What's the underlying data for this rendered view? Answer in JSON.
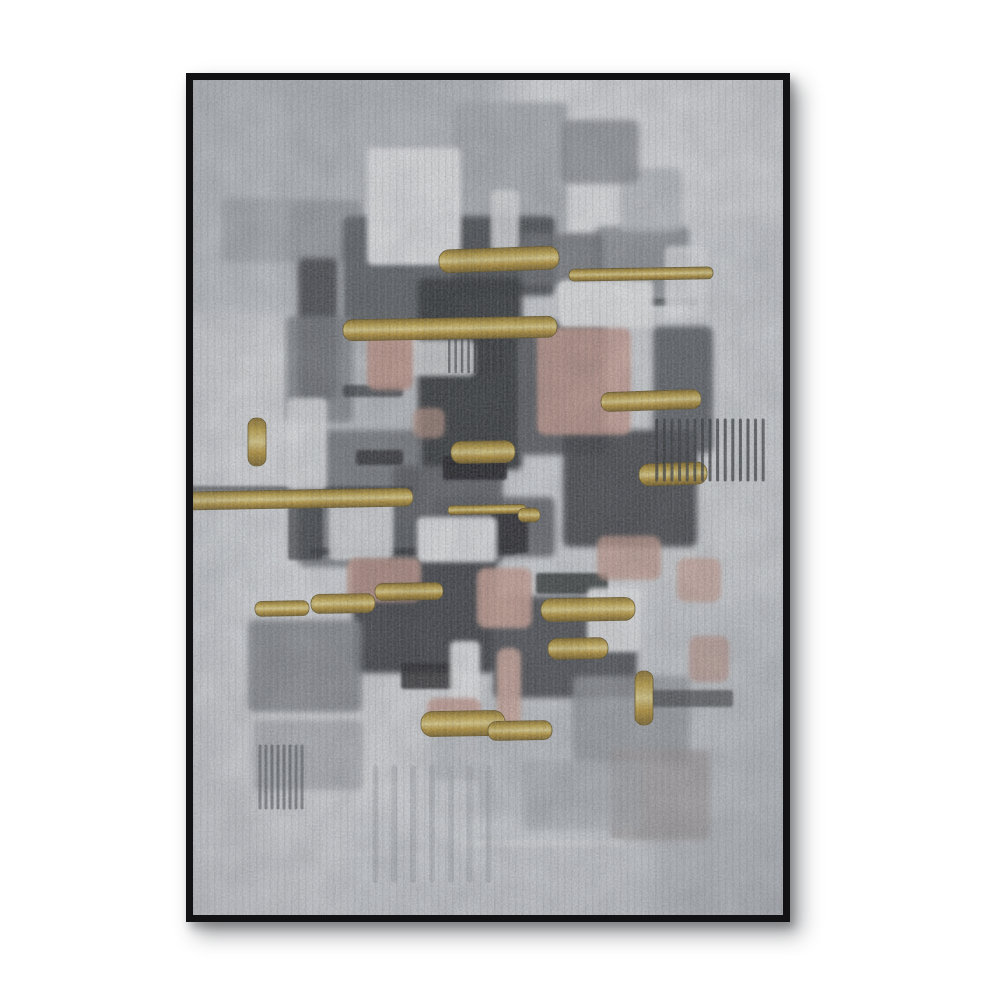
{
  "page": {
    "background": "#ffffff"
  },
  "frame": {
    "color": "#121214",
    "border_px": 7,
    "x": 186,
    "y": 73,
    "width": 604,
    "height": 849,
    "shadow_color": "rgba(40,42,48,0.45)"
  },
  "palette": {
    "canvas_base": "#d9dce0",
    "near_white": "#f2f3f5",
    "light_grey": "#c6cacf",
    "mid_grey": "#9aa0a5",
    "steel_grey": "#54585d",
    "charcoal": "#2f3236",
    "near_black": "#17191c",
    "pink": "#d3a395",
    "salmon": "#c9998b",
    "gold": "#c9a83f",
    "gold_light": "#efdd8d",
    "gold_dark": "#7b6220"
  },
  "painting": {
    "base": "#d9dce0",
    "viewbox": "0 0 590 835",
    "gold_gradient": [
      "#8a6d22",
      "#c9a83f",
      "#efdd8d",
      "#c29a33",
      "#7b6220"
    ],
    "washes": [
      [
        -25,
        -25,
        330,
        310,
        "#ced2d7",
        0.95
      ],
      [
        85,
        -15,
        215,
        265,
        "#bec3c8",
        0.75
      ],
      [
        325,
        -25,
        290,
        230,
        "#edeff1",
        1
      ],
      [
        420,
        140,
        185,
        390,
        "#dde0e3",
        0.9
      ],
      [
        -25,
        235,
        150,
        370,
        "#e6e8ea",
        0.9
      ],
      [
        -25,
        555,
        285,
        305,
        "#e2e4e7",
        0.95
      ],
      [
        235,
        625,
        380,
        235,
        "#c5c9ce",
        0.9
      ],
      [
        100,
        175,
        155,
        255,
        "#b7bcc1",
        0.6
      ],
      [
        455,
        530,
        160,
        215,
        "#ccd0d4",
        0.8
      ],
      [
        150,
        735,
        310,
        125,
        "#d8dbdf",
        0.9
      ],
      [
        -25,
        390,
        120,
        180,
        "#dfe2e5",
        0.8
      ]
    ],
    "blocks": [
      [
        95,
        120,
        74,
        62,
        "#9da1a6",
        0.9
      ],
      [
        260,
        22,
        114,
        132,
        "#b1b5ba",
        0.9
      ],
      [
        402,
        146,
        94,
        74,
        "#8e9297",
        0.9
      ],
      [
        150,
        136,
        114,
        120,
        "#5a5e63",
        0.95
      ],
      [
        260,
        136,
        102,
        80,
        "#45484d",
        0.95
      ],
      [
        225,
        198,
        104,
        192,
        "#2f3236",
        0.97
      ],
      [
        325,
        241,
        88,
        134,
        "#53575c",
        0.95
      ],
      [
        105,
        178,
        40,
        142,
        "#3c4044",
        0.9
      ],
      [
        370,
        350,
        134,
        117,
        "#3a3e43",
        0.92
      ],
      [
        460,
        246,
        60,
        127,
        "#4c5056",
        0.85
      ],
      [
        105,
        350,
        124,
        137,
        "#6e7277",
        0.85
      ],
      [
        160,
        476,
        144,
        117,
        "#33363b",
        0.93
      ],
      [
        300,
        516,
        144,
        102,
        "#3f434a",
        0.9
      ],
      [
        55,
        540,
        114,
        92,
        "#82868b",
        0.85
      ],
      [
        380,
        596,
        117,
        87,
        "#999da2",
        0.8
      ],
      [
        28,
        118,
        72,
        64,
        "#a9afb4",
        0.7
      ],
      [
        200,
        386,
        110,
        97,
        "#54585d",
        0.9
      ],
      [
        93,
        236,
        67,
        107,
        "#7c8085",
        0.8
      ],
      [
        427,
        88,
        62,
        64,
        "#c2c6ca",
        0.8
      ],
      [
        328,
        153,
        82,
        52,
        "#6a6e73",
        0.85
      ],
      [
        368,
        40,
        78,
        64,
        "#8b8f94",
        0.8
      ],
      [
        242,
        417,
        120,
        60,
        "#55595e",
        0.85
      ],
      [
        60,
        640,
        110,
        70,
        "#9ea2a7",
        0.6
      ],
      [
        417,
        670,
        100,
        90,
        "#a8a2a3",
        0.75
      ],
      [
        330,
        680,
        120,
        70,
        "#aeb2b7",
        0.6
      ]
    ],
    "accents": [
      [
        250,
        376,
        64,
        24,
        "#17191c",
        0.9
      ],
      [
        298,
        431,
        37,
        42,
        "#1b1e21",
        0.85
      ],
      [
        163,
        370,
        47,
        15,
        "#202327",
        0.8
      ],
      [
        228,
        116,
        32,
        28,
        "#212428",
        0.8
      ],
      [
        118,
        468,
        205,
        7,
        "#26292d",
        0.7
      ],
      [
        -5,
        406,
        225,
        6,
        "#2a2d31",
        0.6
      ],
      [
        443,
        610,
        97,
        17,
        "#3a3d41",
        0.7
      ],
      [
        208,
        583,
        62,
        26,
        "#202327",
        0.85
      ],
      [
        343,
        493,
        72,
        21,
        "#1d2023",
        0.8
      ],
      [
        150,
        305,
        60,
        12,
        "#26292d",
        0.7
      ],
      [
        385,
        218,
        120,
        8,
        "#2b2e32",
        0.65
      ],
      [
        95,
        425,
        35,
        55,
        "#2c2f33",
        0.7
      ]
    ],
    "whites": [
      [
        174,
        68,
        94,
        117,
        "#f2f3f5",
        0.97
      ],
      [
        366,
        200,
        94,
        48,
        "#f4f5f6",
        0.97
      ],
      [
        94,
        318,
        40,
        92,
        "#eceef0",
        0.9
      ],
      [
        224,
        437,
        80,
        45,
        "#f1f2f4",
        0.97
      ],
      [
        136,
        418,
        64,
        62,
        "#e9ebee",
        0.9
      ],
      [
        394,
        508,
        54,
        64,
        "#f3f4f6",
        0.95
      ],
      [
        257,
        561,
        30,
        70,
        "#f4f5f7",
        0.95
      ],
      [
        204,
        260,
        78,
        36,
        "#e6e8ea",
        0.9
      ],
      [
        298,
        110,
        28,
        62,
        "#eff1f3",
        0.85
      ],
      [
        472,
        166,
        42,
        72,
        "#eef0f2",
        0.85
      ],
      [
        38,
        330,
        45,
        70,
        "#e8eaec",
        0.8
      ],
      [
        205,
        700,
        80,
        60,
        "#dfe2e5",
        0.7
      ],
      [
        270,
        760,
        160,
        6,
        "#e8eaec",
        0.7
      ],
      [
        120,
        772,
        110,
        5,
        "#e4e6e9",
        0.6
      ]
    ],
    "pinks": [
      [
        174,
        248,
        46,
        62,
        "#c9998b",
        0.9
      ],
      [
        344,
        248,
        94,
        107,
        "#d3a395",
        0.85
      ],
      [
        154,
        478,
        74,
        44,
        "#cfa093",
        0.85
      ],
      [
        284,
        488,
        55,
        60,
        "#d6a99b",
        0.9
      ],
      [
        404,
        456,
        64,
        44,
        "#cda092",
        0.8
      ],
      [
        484,
        478,
        44,
        44,
        "#d4a89a",
        0.75
      ],
      [
        304,
        568,
        24,
        84,
        "#dcb2a4",
        0.9
      ],
      [
        234,
        618,
        54,
        34,
        "#d0a194",
        0.85
      ],
      [
        220,
        328,
        32,
        30,
        "#c79c8e",
        0.7
      ],
      [
        496,
        556,
        40,
        46,
        "#c4988c",
        0.7
      ]
    ],
    "golds": [
      [
        246,
        168,
        120,
        23,
        -2
      ],
      [
        376,
        188,
        144,
        12,
        -1
      ],
      [
        150,
        238,
        214,
        21,
        -1
      ],
      [
        55,
        338,
        18,
        48,
        0
      ],
      [
        408,
        311,
        100,
        19,
        -2
      ],
      [
        258,
        361,
        64,
        22,
        -1
      ],
      [
        -8,
        410,
        228,
        18,
        -1
      ],
      [
        255,
        425,
        78,
        9,
        -1
      ],
      [
        446,
        383,
        68,
        22,
        -2
      ],
      [
        62,
        521,
        54,
        15,
        -1
      ],
      [
        118,
        514,
        64,
        19,
        -1
      ],
      [
        182,
        503,
        68,
        17,
        -1
      ],
      [
        348,
        518,
        94,
        23,
        -1
      ],
      [
        355,
        558,
        60,
        21,
        -1
      ],
      [
        442,
        591,
        18,
        54,
        0
      ],
      [
        228,
        631,
        84,
        25,
        -1
      ],
      [
        295,
        641,
        64,
        19,
        -1
      ],
      [
        325,
        428,
        22,
        14,
        0
      ]
    ],
    "combs": [
      [
        460,
        340,
        114,
        60,
        15,
        "#2e3135",
        3,
        0.75
      ],
      [
        64,
        666,
        48,
        62,
        8,
        "#4a4e53",
        3,
        0.6
      ],
      [
        253,
        260,
        58,
        32,
        9,
        "#26292d",
        2.5,
        0.6
      ],
      [
        173,
        688,
        132,
        112,
        7,
        "#a9adb2",
        6,
        0.45
      ]
    ]
  }
}
